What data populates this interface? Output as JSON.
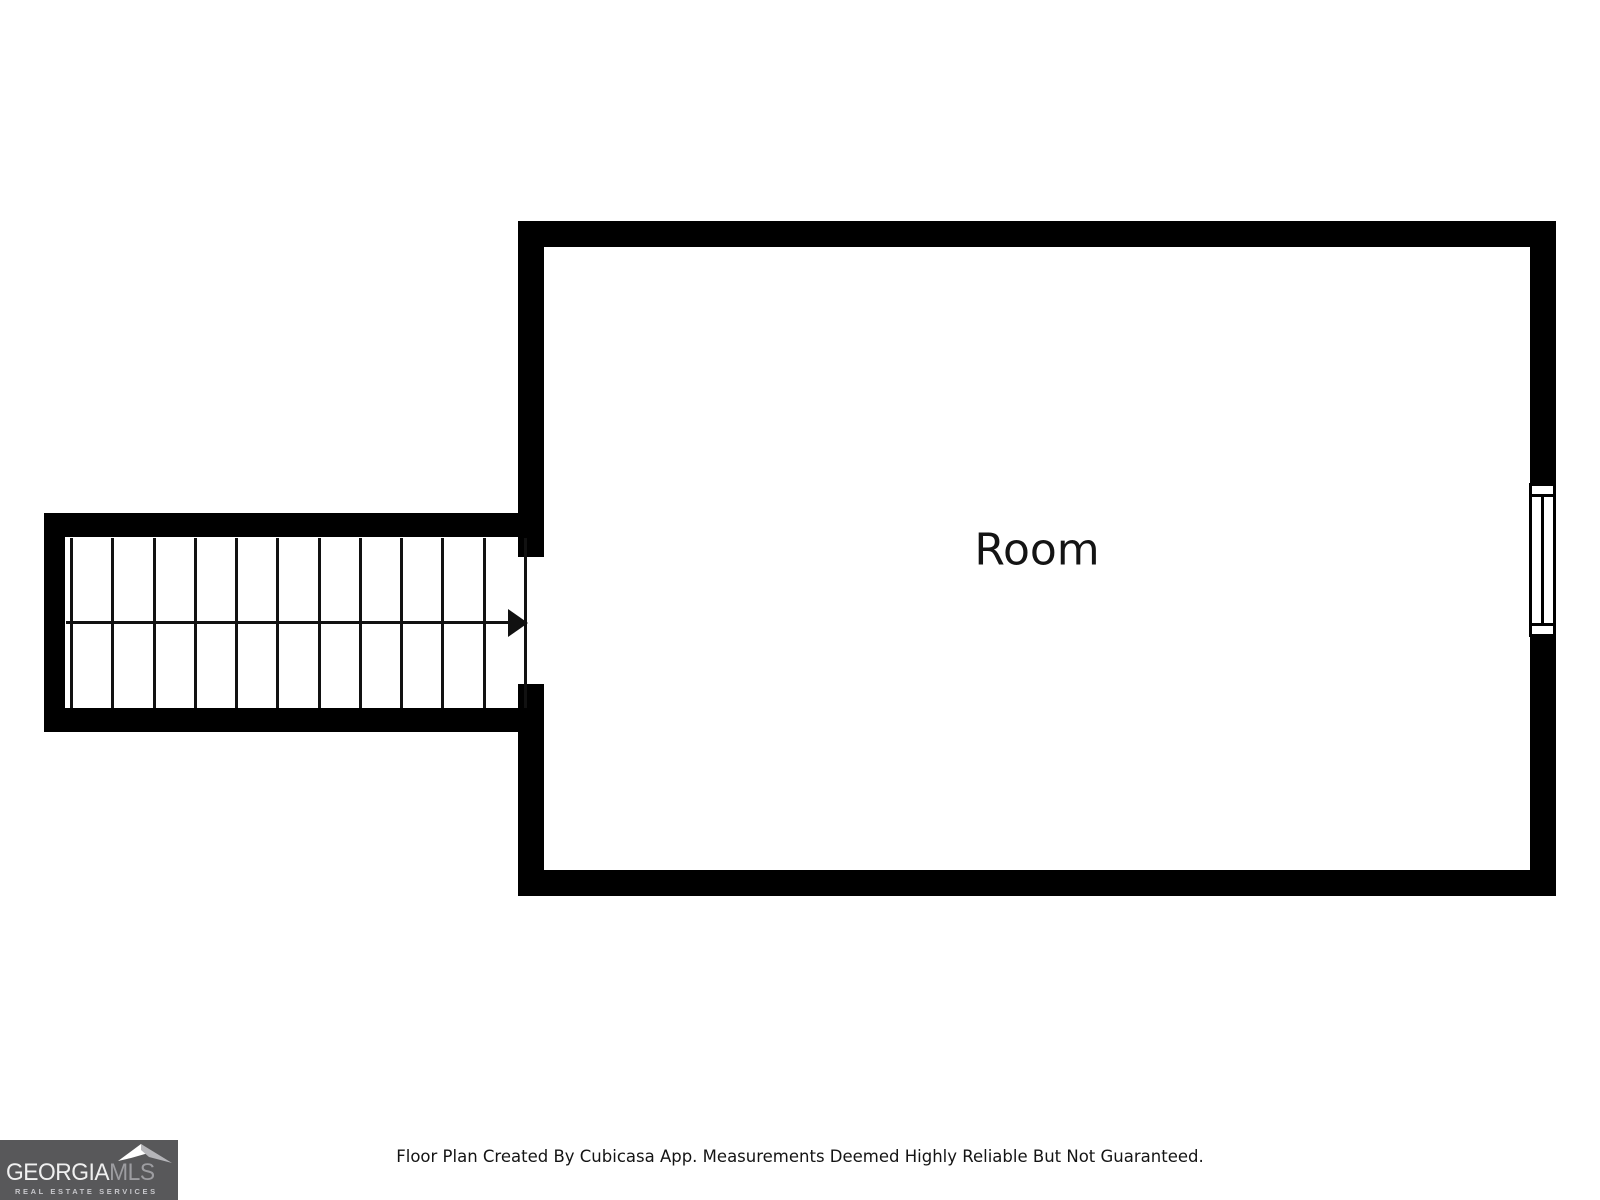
{
  "page": {
    "background": "#ffffff"
  },
  "floor_plan": {
    "room": {
      "label": "Room"
    },
    "stairs": {
      "tread_count": 11,
      "direction_icon": "arrow-right-icon"
    },
    "window_icon": "window-icon",
    "colors": {
      "wall": "#000000",
      "stair_line": "#111111"
    }
  },
  "footer": {
    "disclaimer": "Floor Plan Created By Cubicasa App. Measurements Deemed Highly Reliable But Not Guaranteed."
  },
  "logo": {
    "brand_primary": "GEORGIA",
    "brand_secondary": "MLS",
    "tagline": "REAL ESTATE SERVICES",
    "roof_icon": "roof-icon",
    "colors": {
      "background": "#58585a",
      "primary_text": "#f0f0f0",
      "secondary_text": "#9d9da1",
      "tagline_text": "#c7c7cb",
      "roof_left": "#ffffff",
      "roof_right": "#b5b5b9"
    }
  }
}
